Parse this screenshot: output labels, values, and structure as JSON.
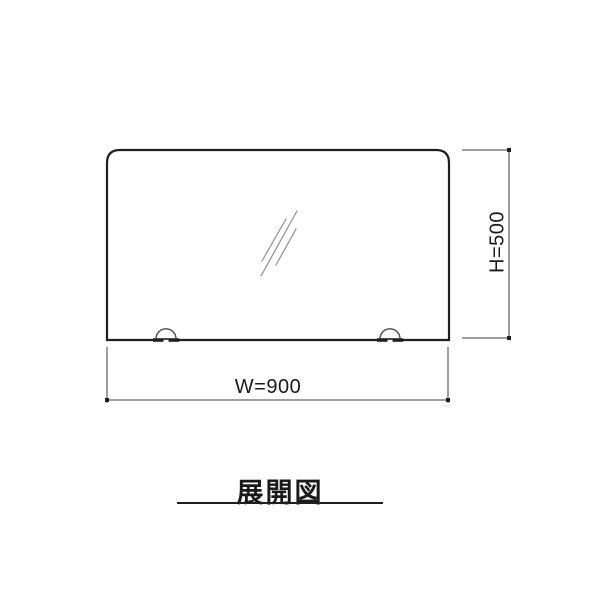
{
  "page": {
    "background": "#ffffff"
  },
  "colors": {
    "page_bg": "#ffffff",
    "panel_line": "#1f1f1f",
    "dim_line": "#3f3f3f",
    "glass_mark": "#8f8f8f",
    "text_color": "#1a1a1a"
  },
  "drawing": {
    "panel_shape": "rectangle-rounded-top-corners",
    "glass_marks_icon": "glass-reflection-marks",
    "clip_icons": [
      "mounting-clip-left",
      "mounting-clip-right"
    ]
  },
  "dimensions": {
    "width_label": "W=900",
    "height_label": "H=500"
  },
  "caption": {
    "text": "展開図"
  }
}
